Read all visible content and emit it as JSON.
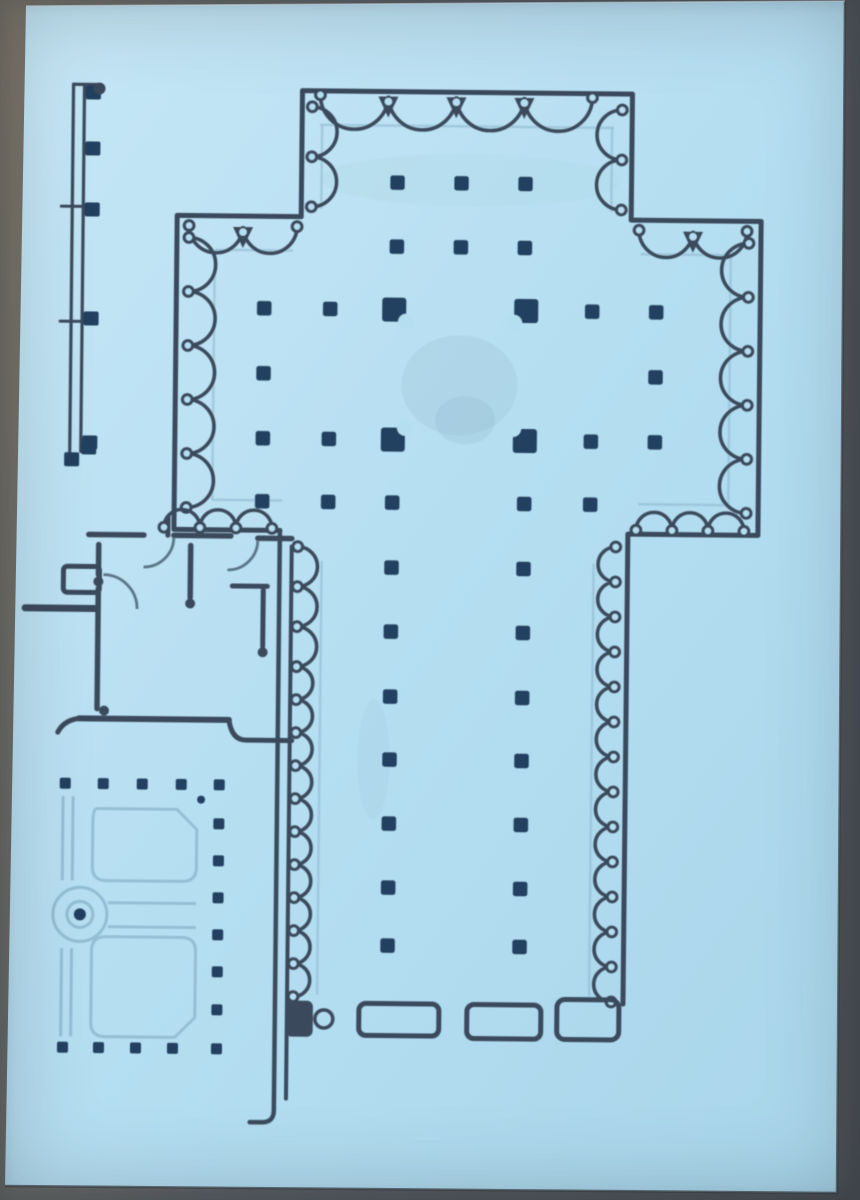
{
  "meta": {
    "description": "Photograph of a printed architectural floor plan of a cruciform basilica church with side chapels, cloister and monastic rooms, on light blue paper",
    "width": 860,
    "height": 1200
  },
  "palette": {
    "paper_light": "#c6e7f6",
    "paper_mid": "#b5def1",
    "paper_deep": "#a9d5ea",
    "ink": "#3a4a5c",
    "pier": "#20405f",
    "faint": "#8fb9cf",
    "door": "#5a7486",
    "edge_shadow": "#3c4045",
    "edge_highlight": "#e2f2fa"
  },
  "paper": {
    "points": "26,6 845,1 837,1193 5,1186",
    "edge_shadow_d": "M 845 1 L 837 1193 L 5 1186",
    "edge_highlight_d": "M 26 6 L 845 1"
  },
  "plan": {
    "rotation": "rotate(0.6 430 140)",
    "walls": [
      {
        "d": "M 302 218 L 302 92 L 632 92 L 632 218 L 762 218 L 762 532 L 632 532 L 632 1002",
        "w": 5
      },
      {
        "d": "M 302 218 L 178 218 L 178 532 L 284 532",
        "w": 5
      },
      {
        "d": "M 284 532 L 284 1112 Q 284 1124 272 1124 L 260 1124",
        "w": 4.5
      },
      {
        "d": "M 296 548 L 296 1100",
        "w": 4
      },
      {
        "d": "M 172 538 L 172 520",
        "w": 5
      },
      {
        "d": "M 93 538 L 148 538",
        "w": 5.5
      },
      {
        "d": "M 178 538 L 235 538",
        "w": 5.5
      },
      {
        "d": "M 262 540 L 296 540",
        "w": 5.5
      },
      {
        "d": "M 103 548 L 103 578",
        "w": 5.5
      },
      {
        "d": "M 103 592 L 103 712",
        "w": 5.5
      },
      {
        "d": "M 30 612 L 100 612",
        "w": 7
      },
      {
        "d": "M 195 548 L 195 600",
        "w": 5.5
      },
      {
        "d": "M 237 588 L 272 588",
        "w": 5
      },
      {
        "d": "M 268 592 L 268 648",
        "w": 5
      },
      {
        "d": "M 85 722 L 235 722",
        "w": 6
      },
      {
        "d": "M 235 722 Q 238 742 252 742 L 298 742",
        "w": 5
      },
      {
        "d": "M 85 722 Q 70 724 64 736",
        "w": 5
      }
    ],
    "faint_lines": [
      {
        "d": "M 320 126 L 614 126"
      },
      {
        "d": "M 322 126 L 322 210"
      },
      {
        "d": "M 612 126 L 612 210"
      },
      {
        "d": "M 216 252 L 294 252"
      },
      {
        "d": "M 642 252 L 732 252"
      },
      {
        "d": "M 216 252 L 216 502"
      },
      {
        "d": "M 732 252 L 732 502"
      },
      {
        "d": "M 216 502 L 286 502"
      },
      {
        "d": "M 642 502 L 732 502"
      },
      {
        "d": "M 326 562 L 326 996"
      },
      {
        "d": "M 598 562 L 598 996"
      }
    ],
    "chains": [
      {
        "x": 320,
        "y": 96,
        "dir": "h",
        "bulge": "down",
        "r": 34,
        "count": 4,
        "knot": "vee"
      },
      {
        "x": 312,
        "y": 108,
        "dir": "v",
        "bulge": "right",
        "r": 25,
        "count": 2,
        "knot": "round"
      },
      {
        "x": 622,
        "y": 108,
        "dir": "v",
        "bulge": "left",
        "r": 25,
        "count": 2,
        "knot": "round"
      },
      {
        "x": 190,
        "y": 228,
        "dir": "h",
        "bulge": "down",
        "r": 27,
        "count": 2,
        "knot": "vee"
      },
      {
        "x": 640,
        "y": 228,
        "dir": "h",
        "bulge": "down",
        "r": 27,
        "count": 2,
        "knot": "vee"
      },
      {
        "x": 190,
        "y": 240,
        "dir": "v",
        "bulge": "right",
        "r": 27,
        "count": 5,
        "knot": "round"
      },
      {
        "x": 750,
        "y": 240,
        "dir": "v",
        "bulge": "left",
        "r": 27,
        "count": 5,
        "knot": "round"
      },
      {
        "x": 168,
        "y": 530,
        "dir": "h",
        "bulge": "up",
        "r": 18,
        "count": 3,
        "knot": "round"
      },
      {
        "x": 640,
        "y": 528,
        "dir": "h",
        "bulge": "up",
        "r": 18,
        "count": 3,
        "knot": "round"
      },
      {
        "x": 302,
        "y": 548,
        "dir": "v",
        "bulge": "right",
        "r": 20,
        "count": 3,
        "knot": "round"
      },
      {
        "x": 302,
        "y": 668,
        "dir": "v",
        "bulge": "right",
        "r": 16.5,
        "count": 10,
        "knot": "round"
      },
      {
        "x": 620,
        "y": 545,
        "dir": "v",
        "bulge": "left",
        "r": 17.5,
        "count": 13,
        "knot": "round"
      }
    ],
    "pier_rows": {
      "size": 14.5,
      "rows": [
        {
          "y": 183,
          "xs": [
            398,
            462,
            526
          ]
        },
        {
          "y": 247,
          "xs": [
            398,
            462,
            526
          ]
        },
        {
          "y": 310,
          "xs": [
            266,
            332,
            594,
            658
          ]
        },
        {
          "y": 375,
          "xs": [
            266,
            658
          ]
        },
        {
          "y": 440,
          "xs": [
            266,
            332,
            594,
            658
          ]
        },
        {
          "y": 503,
          "xs": [
            266,
            332,
            396,
            528,
            594
          ]
        },
        {
          "y": 568,
          "xs": [
            396,
            528
          ]
        },
        {
          "y": 632,
          "xs": [
            396,
            528
          ]
        },
        {
          "y": 697,
          "xs": [
            396,
            528
          ]
        },
        {
          "y": 760,
          "xs": [
            396,
            528
          ]
        },
        {
          "y": 824,
          "xs": [
            396,
            528
          ]
        },
        {
          "y": 888,
          "xs": [
            396,
            528
          ]
        },
        {
          "y": 946,
          "xs": [
            396,
            528
          ]
        }
      ]
    },
    "crossing_piers": {
      "size": 24,
      "notch_r": 8,
      "center": [
        462,
        375
      ],
      "positions": [
        [
          396,
          310
        ],
        [
          528,
          310
        ],
        [
          396,
          440
        ],
        [
          528,
          440
        ]
      ]
    },
    "outlined_blocks": [
      {
        "x": 368,
        "y": 1004,
        "w": 80,
        "h": 32,
        "rx": 7,
        "sw": 5
      },
      {
        "x": 476,
        "y": 1004,
        "w": 74,
        "h": 34,
        "rx": 7,
        "sw": 5
      },
      {
        "x": 566,
        "y": 998,
        "w": 62,
        "h": 40,
        "rx": 8,
        "sw": 5
      },
      {
        "x": 68,
        "y": 570,
        "w": 36,
        "h": 26,
        "rx": 4,
        "sw": 5
      }
    ],
    "filled_blocks": [
      {
        "x": 295,
        "y": 1002,
        "w": 27,
        "h": 36,
        "rx": 6
      }
    ],
    "rings": [
      {
        "cx": 333,
        "cy": 1020,
        "r": 9
      }
    ],
    "knob_dots": [
      [
        195,
        606
      ],
      [
        268,
        654
      ],
      [
        103,
        585
      ],
      [
        110,
        714
      ]
    ],
    "door_arcs": [
      {
        "d": "M 108 578 A 34 34 0 0 1 142 612"
      },
      {
        "d": "M 178 540 A 30 30 0 0 1 148 570"
      },
      {
        "d": "M 262 542 A 30 30 0 0 1 232 572"
      }
    ],
    "portico": {
      "lines": [
        {
          "d": "M 73 88 L 73 462",
          "w": 3.2
        },
        {
          "d": "M 84 90 L 84 455",
          "w": 3.2
        },
        {
          "d": "M 73 88 L 98 88",
          "w": 3.2
        },
        {
          "d": "M 62 210 L 88 210",
          "w": 3
        },
        {
          "d": "M 62 325 L 88 325",
          "w": 3
        }
      ],
      "block_size": [
        15,
        14
      ],
      "blocks": [
        [
          93,
          96
        ],
        [
          93,
          152
        ],
        [
          93,
          213
        ],
        [
          93,
          322
        ],
        [
          93,
          446
        ],
        [
          75,
          463
        ],
        [
          92,
          451
        ]
      ],
      "end_dots": [
        [
          99,
          92
        ]
      ]
    },
    "cloister": {
      "dot_size": 11,
      "top_row": {
        "y": 787,
        "xs": [
          72,
          110,
          149,
          188,
          226
        ]
      },
      "right_col": {
        "x": 226,
        "ys": [
          826,
          863,
          900,
          937,
          974,
          1012
        ]
      },
      "bottom_row": {
        "y": 1051,
        "xs": [
          72,
          108,
          145,
          182,
          226
        ]
      },
      "extra_dot": [
        208,
        802
      ],
      "garden_paths": [
        {
          "d": "M 104 812 L 184 812 L 204 832 L 204 870 Q 204 884 190 884 L 114 884 Q 100 884 100 870 L 100 826 Q 100 812 104 812 Z"
        },
        {
          "d": "M 114 940 L 190 940 Q 204 940 204 954 L 204 1020 L 184 1040 L 114 1040 Q 100 1040 100 1026 L 100 954 Q 100 940 114 940 Z"
        },
        {
          "d": "M 70 800 L 70 884"
        },
        {
          "d": "M 80 800 L 80 884"
        },
        {
          "d": "M 70 952 L 70 1040"
        },
        {
          "d": "M 80 952 L 80 1040"
        },
        {
          "d": "M 116 906 L 204 906"
        },
        {
          "d": "M 116 930 L 204 930"
        }
      ],
      "fountain": {
        "cx": 88,
        "cy": 918,
        "r_outer": 27,
        "r_inner": 13,
        "dot_r": 6
      }
    },
    "smudges": [
      {
        "cx": 462,
        "cy": 385,
        "rx": 58,
        "ry": 50,
        "fill": "#8cb4c4",
        "o": 0.22
      },
      {
        "cx": 468,
        "cy": 420,
        "rx": 30,
        "ry": 24,
        "fill": "#7fa8ba",
        "o": 0.18
      },
      {
        "cx": 470,
        "cy": 180,
        "rx": 150,
        "ry": 26,
        "fill": "#9fd0d4",
        "o": 0.15
      },
      {
        "cx": 380,
        "cy": 760,
        "rx": 16,
        "ry": 60,
        "fill": "#8cb4c4",
        "o": 0.1
      }
    ]
  }
}
